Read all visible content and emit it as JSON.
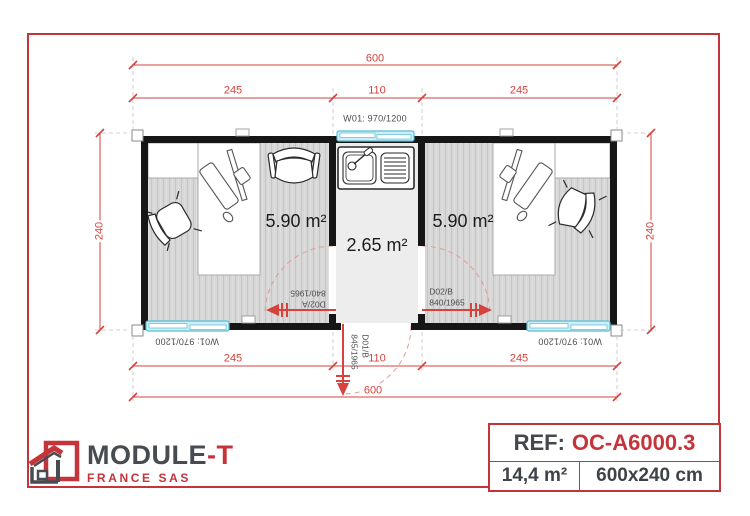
{
  "plan": {
    "area_left": "5.90 m²",
    "area_center": "2.65 m²",
    "area_right": "5.90 m²",
    "dim_top_total": "600",
    "dim_top_left": "245",
    "dim_top_mid": "110",
    "dim_top_right": "245",
    "dim_bottom_total": "600",
    "dim_bottom_left": "245",
    "dim_bottom_mid": "110",
    "dim_bottom_right": "245",
    "dim_side_left": "240",
    "dim_side_right": "240",
    "window_top_label": "W01: 970/1200",
    "window_bottom_left_label": "W01: 970/1200",
    "window_bottom_right_label": "W01: 970/1200",
    "door_left": {
      "id": "D02/A",
      "size": "840/1965"
    },
    "door_center": {
      "id": "D01/B",
      "size": "845/1965"
    },
    "door_right": {
      "id": "D02/B",
      "size": "840/1965"
    }
  },
  "footer": {
    "brand_main": "MODULE",
    "brand_accent": "-T",
    "brand_sub": "FRANCE SAS",
    "ref_label": "REF:",
    "ref_value": "OC-A6000.3",
    "total_area": "14,4 m²",
    "dimensions_cm": "600x240 cm"
  },
  "colors": {
    "accent_red": "#c5333b",
    "dimension_red": "#d5433c",
    "wall_black": "#161616",
    "window_cyan": "#cdeef6",
    "window_cyan_stroke": "#58bed4",
    "floor_gray": "#d7d7d7",
    "corridor_gray": "#ededed",
    "swing_arc_pink": "#de9d96"
  }
}
